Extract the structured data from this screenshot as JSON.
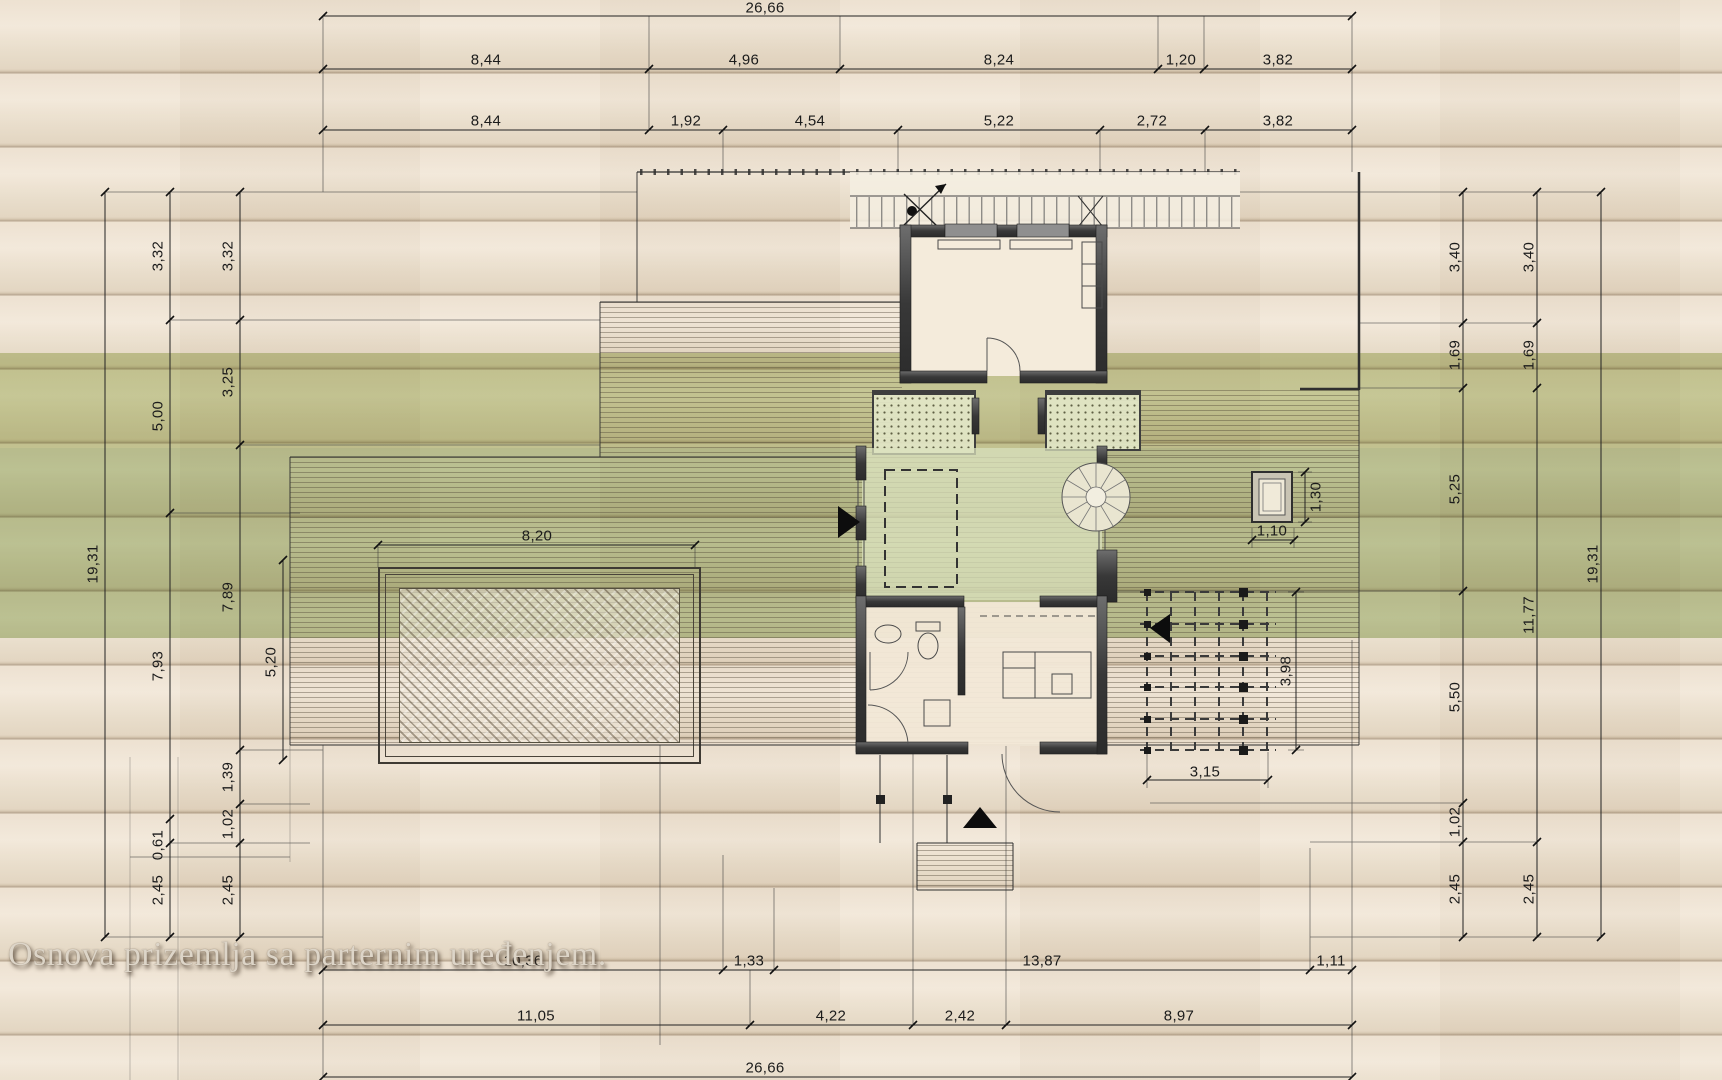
{
  "title": {
    "text": "Osnova prizemlja sa parternim uređenjem."
  },
  "drawing": {
    "kind": "architectural ground-floor site plan",
    "overall_width_m": "26,66",
    "overall_depth_m": "19,31"
  },
  "colors": {
    "wood": "#e9ddcc",
    "plank_line": "#b2a089",
    "grass_band": "#c6d3aa",
    "deck_hatch": "#4c4232",
    "wall": "#3f3f3f",
    "dimension_text": "#1b1b1b",
    "title_text": "#ddd5c8"
  },
  "dimensions": [
    {
      "text": "26,66",
      "x": 765,
      "y": 8,
      "o": "h"
    },
    {
      "text": "8,44",
      "x": 486,
      "y": 60,
      "o": "h"
    },
    {
      "text": "4,96",
      "x": 744,
      "y": 60,
      "o": "h"
    },
    {
      "text": "8,24",
      "x": 999,
      "y": 60,
      "o": "h"
    },
    {
      "text": "1,20",
      "x": 1181,
      "y": 60,
      "o": "h"
    },
    {
      "text": "3,82",
      "x": 1278,
      "y": 60,
      "o": "h"
    },
    {
      "text": "8,44",
      "x": 486,
      "y": 121,
      "o": "h"
    },
    {
      "text": "1,92",
      "x": 686,
      "y": 121,
      "o": "h"
    },
    {
      "text": "4,54",
      "x": 810,
      "y": 121,
      "o": "h"
    },
    {
      "text": "5,22",
      "x": 999,
      "y": 121,
      "o": "h"
    },
    {
      "text": "2,72",
      "x": 1152,
      "y": 121,
      "o": "h"
    },
    {
      "text": "3,82",
      "x": 1278,
      "y": 121,
      "o": "h"
    },
    {
      "text": "10,36",
      "x": 523,
      "y": 961,
      "o": "h"
    },
    {
      "text": "1,33",
      "x": 749,
      "y": 961,
      "o": "h"
    },
    {
      "text": "13,87",
      "x": 1042,
      "y": 961,
      "o": "h"
    },
    {
      "text": "1,11",
      "x": 1331,
      "y": 961,
      "o": "h"
    },
    {
      "text": "11,05",
      "x": 536,
      "y": 1016,
      "o": "h"
    },
    {
      "text": "4,22",
      "x": 831,
      "y": 1016,
      "o": "h"
    },
    {
      "text": "2,42",
      "x": 960,
      "y": 1016,
      "o": "h"
    },
    {
      "text": "8,97",
      "x": 1179,
      "y": 1016,
      "o": "h"
    },
    {
      "text": "26,66",
      "x": 765,
      "y": 1068,
      "o": "h"
    },
    {
      "text": "19,31",
      "x": 93,
      "y": 564,
      "o": "v"
    },
    {
      "text": "3,32",
      "x": 158,
      "y": 256,
      "o": "v"
    },
    {
      "text": "5,00",
      "x": 158,
      "y": 416,
      "o": "v"
    },
    {
      "text": "7,93",
      "x": 158,
      "y": 666,
      "o": "v"
    },
    {
      "text": "0,61",
      "x": 158,
      "y": 845,
      "o": "v"
    },
    {
      "text": "2,45",
      "x": 158,
      "y": 890,
      "o": "v"
    },
    {
      "text": "3,32",
      "x": 228,
      "y": 256,
      "o": "v"
    },
    {
      "text": "3,25",
      "x": 228,
      "y": 382,
      "o": "v"
    },
    {
      "text": "7,89",
      "x": 228,
      "y": 597,
      "o": "v"
    },
    {
      "text": "1,39",
      "x": 228,
      "y": 777,
      "o": "v"
    },
    {
      "text": "1,02",
      "x": 228,
      "y": 824,
      "o": "v"
    },
    {
      "text": "2,45",
      "x": 228,
      "y": 890,
      "o": "v"
    },
    {
      "text": "5,20",
      "x": 271,
      "y": 662,
      "o": "v"
    },
    {
      "text": "8,20",
      "x": 537,
      "y": 536,
      "o": "h"
    },
    {
      "text": "3,40",
      "x": 1455,
      "y": 257,
      "o": "v"
    },
    {
      "text": "1,69",
      "x": 1455,
      "y": 355,
      "o": "v"
    },
    {
      "text": "5,25",
      "x": 1455,
      "y": 489,
      "o": "v"
    },
    {
      "text": "5,50",
      "x": 1455,
      "y": 697,
      "o": "v"
    },
    {
      "text": "1,02",
      "x": 1455,
      "y": 822,
      "o": "v"
    },
    {
      "text": "2,45",
      "x": 1455,
      "y": 889,
      "o": "v"
    },
    {
      "text": "3,40",
      "x": 1529,
      "y": 257,
      "o": "v"
    },
    {
      "text": "1,69",
      "x": 1529,
      "y": 355,
      "o": "v"
    },
    {
      "text": "11,77",
      "x": 1529,
      "y": 615,
      "o": "v"
    },
    {
      "text": "2,45",
      "x": 1529,
      "y": 889,
      "o": "v"
    },
    {
      "text": "19,31",
      "x": 1593,
      "y": 564,
      "o": "v"
    },
    {
      "text": "1,30",
      "x": 1316,
      "y": 497,
      "o": "v"
    },
    {
      "text": "1,10",
      "x": 1272,
      "y": 531,
      "o": "h"
    },
    {
      "text": "3,98",
      "x": 1286,
      "y": 671,
      "o": "v"
    },
    {
      "text": "3,15",
      "x": 1205,
      "y": 772,
      "o": "h"
    }
  ]
}
